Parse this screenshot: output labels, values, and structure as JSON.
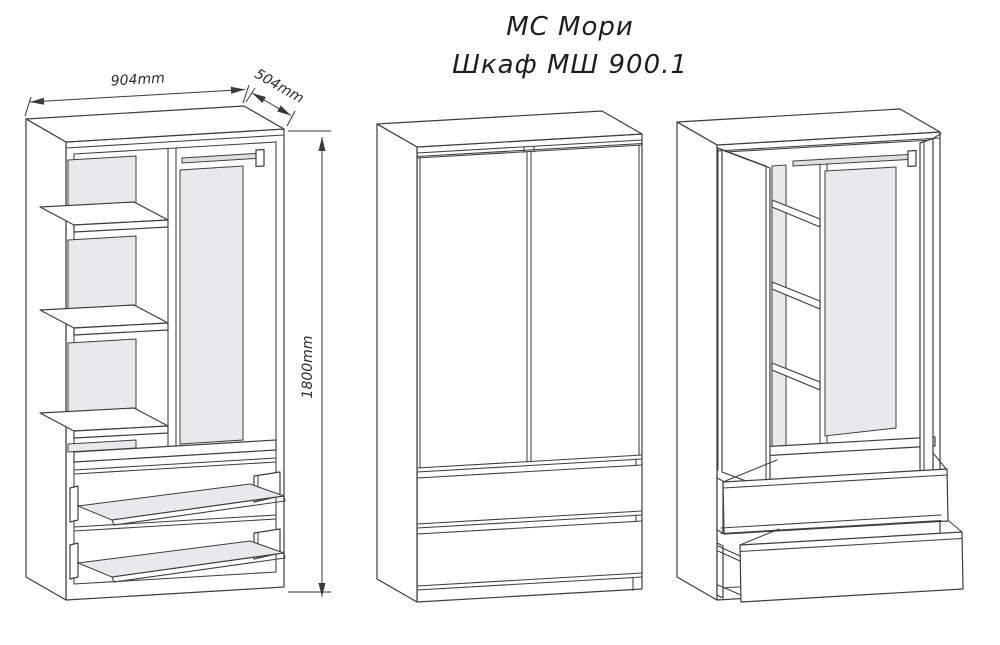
{
  "title": {
    "line1": "МС Мори",
    "line2": "Шкаф МШ 900.1"
  },
  "dimensions": {
    "width": "904mm",
    "depth": "504mm",
    "height": "1800mm"
  },
  "colors": {
    "line": "#3e3e3e",
    "panel_gray": "#e9e9eb",
    "background": "#ffffff"
  }
}
